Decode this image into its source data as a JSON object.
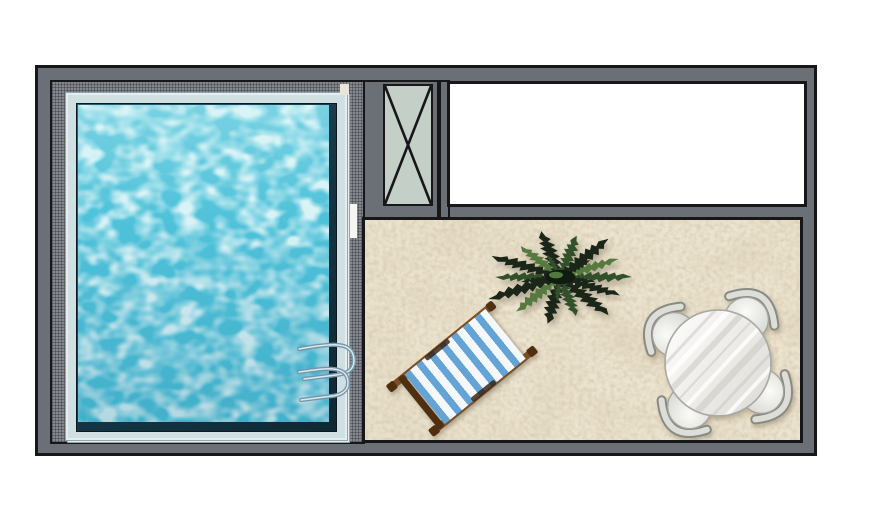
{
  "scene": {
    "plan_label": "Poolside terrace floor plan (top view illustration)",
    "regions": {
      "pool": "Swimming pool",
      "deck": "Pool surround deck",
      "column": "Crossed square marker",
      "room": "Empty room",
      "terrace": "Sandy terrace"
    },
    "objects": {
      "ladder": "Pool ladder",
      "palm": "Palm tree top view",
      "lounger": "Blue striped deck chair top view",
      "dining": "Round table with four chairs top view"
    }
  },
  "colors": {
    "page-bg": "#ffffff",
    "wall": "#6b6f76",
    "line": "#17171a",
    "deck-base": "#85898f",
    "deck-grid": "rgba(40,44,52,.38)",
    "coping": "#d0dfe1",
    "coping-edge": "#8fa6ac",
    "basin-deep": "#0f2833",
    "basin-lip": "#2f6274",
    "water": "#4fc2da",
    "water-glow": "#ddf6f7",
    "xbox-fill": "#c4cfc7",
    "room-fill": "#ffffff",
    "sand": "#ede4d0",
    "palm-dark": "#1b2619",
    "palm-mid": "#33502c",
    "palm-light": "#567a3e",
    "palm-core": "#101c11",
    "wood": "#7d4e23",
    "wood-dark": "#4e3010",
    "stripe-blue": "#64a3d6",
    "stripe-white": "#f4f8fb",
    "metal": "#7695a6",
    "metal-light": "#d9ebf2",
    "seat-edge": "#a3a39d",
    "back-rail": "#deded8",
    "back-rail-edge": "#8a8a84",
    "marble-streak": "#c9c9c3",
    "table-edge": "#aaaaa4"
  }
}
